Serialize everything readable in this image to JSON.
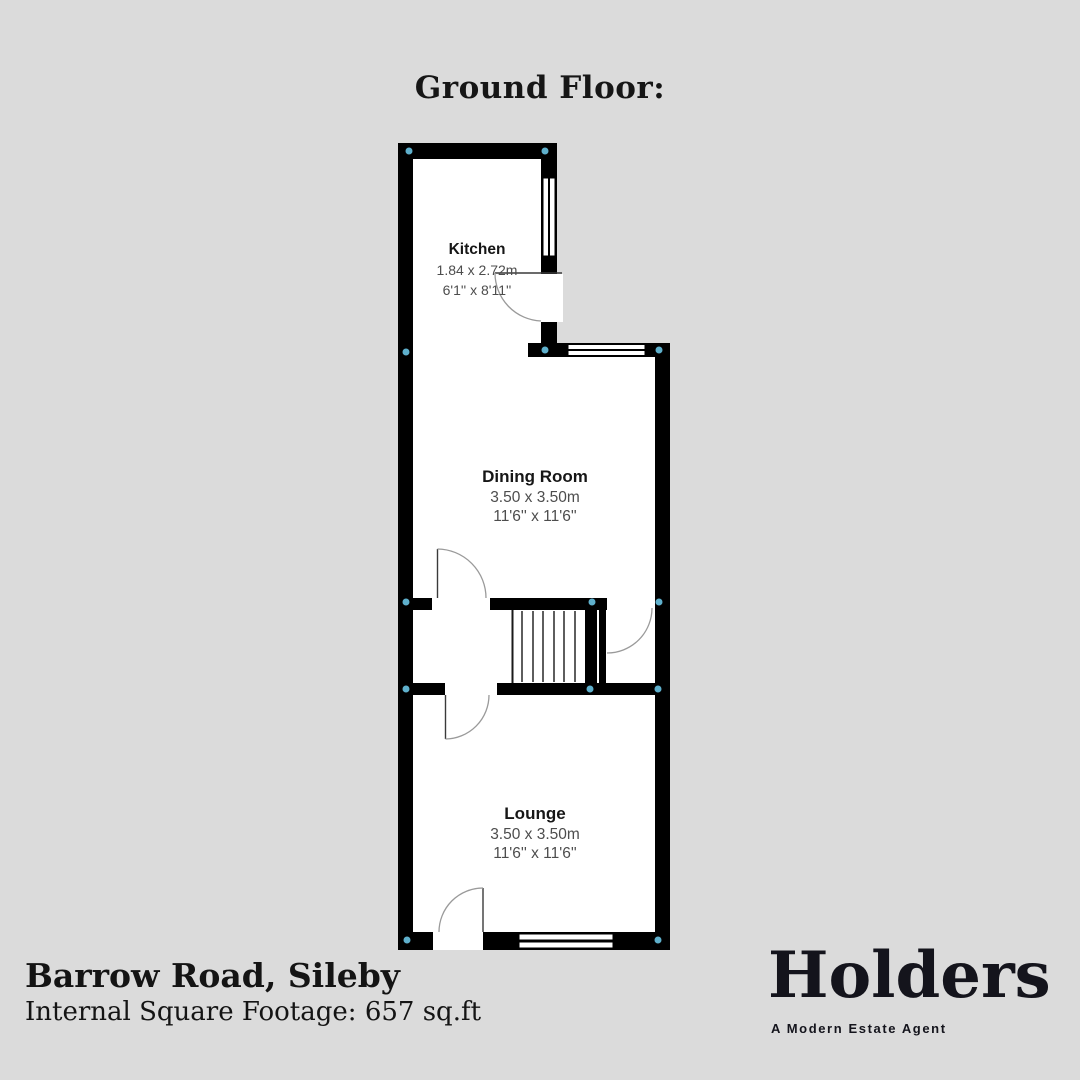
{
  "title": "Ground Floor:",
  "colors": {
    "background": "#dbdbdb",
    "wall": "#000000",
    "floor": "#ffffff",
    "corner_dot": "#5fb0cc",
    "dim_text": "#4d4d4d",
    "brand": "#14141c"
  },
  "rooms": [
    {
      "name": "Kitchen",
      "metric": "1.84 x 2.72m",
      "imperial": "6'1'' x 8'11''"
    },
    {
      "name": "Dining Room",
      "metric": "3.50 x 3.50m",
      "imperial": "11'6'' x 11'6''"
    },
    {
      "name": "Lounge",
      "metric": "3.50 x 3.50m",
      "imperial": "11'6'' x 11'6''"
    }
  ],
  "footer": {
    "address": "Barrow Road, Sileby",
    "footage": "Internal Square Footage: 657 sq.ft"
  },
  "brand": {
    "name": "Holders",
    "tagline": "A Modern Estate Agent"
  }
}
